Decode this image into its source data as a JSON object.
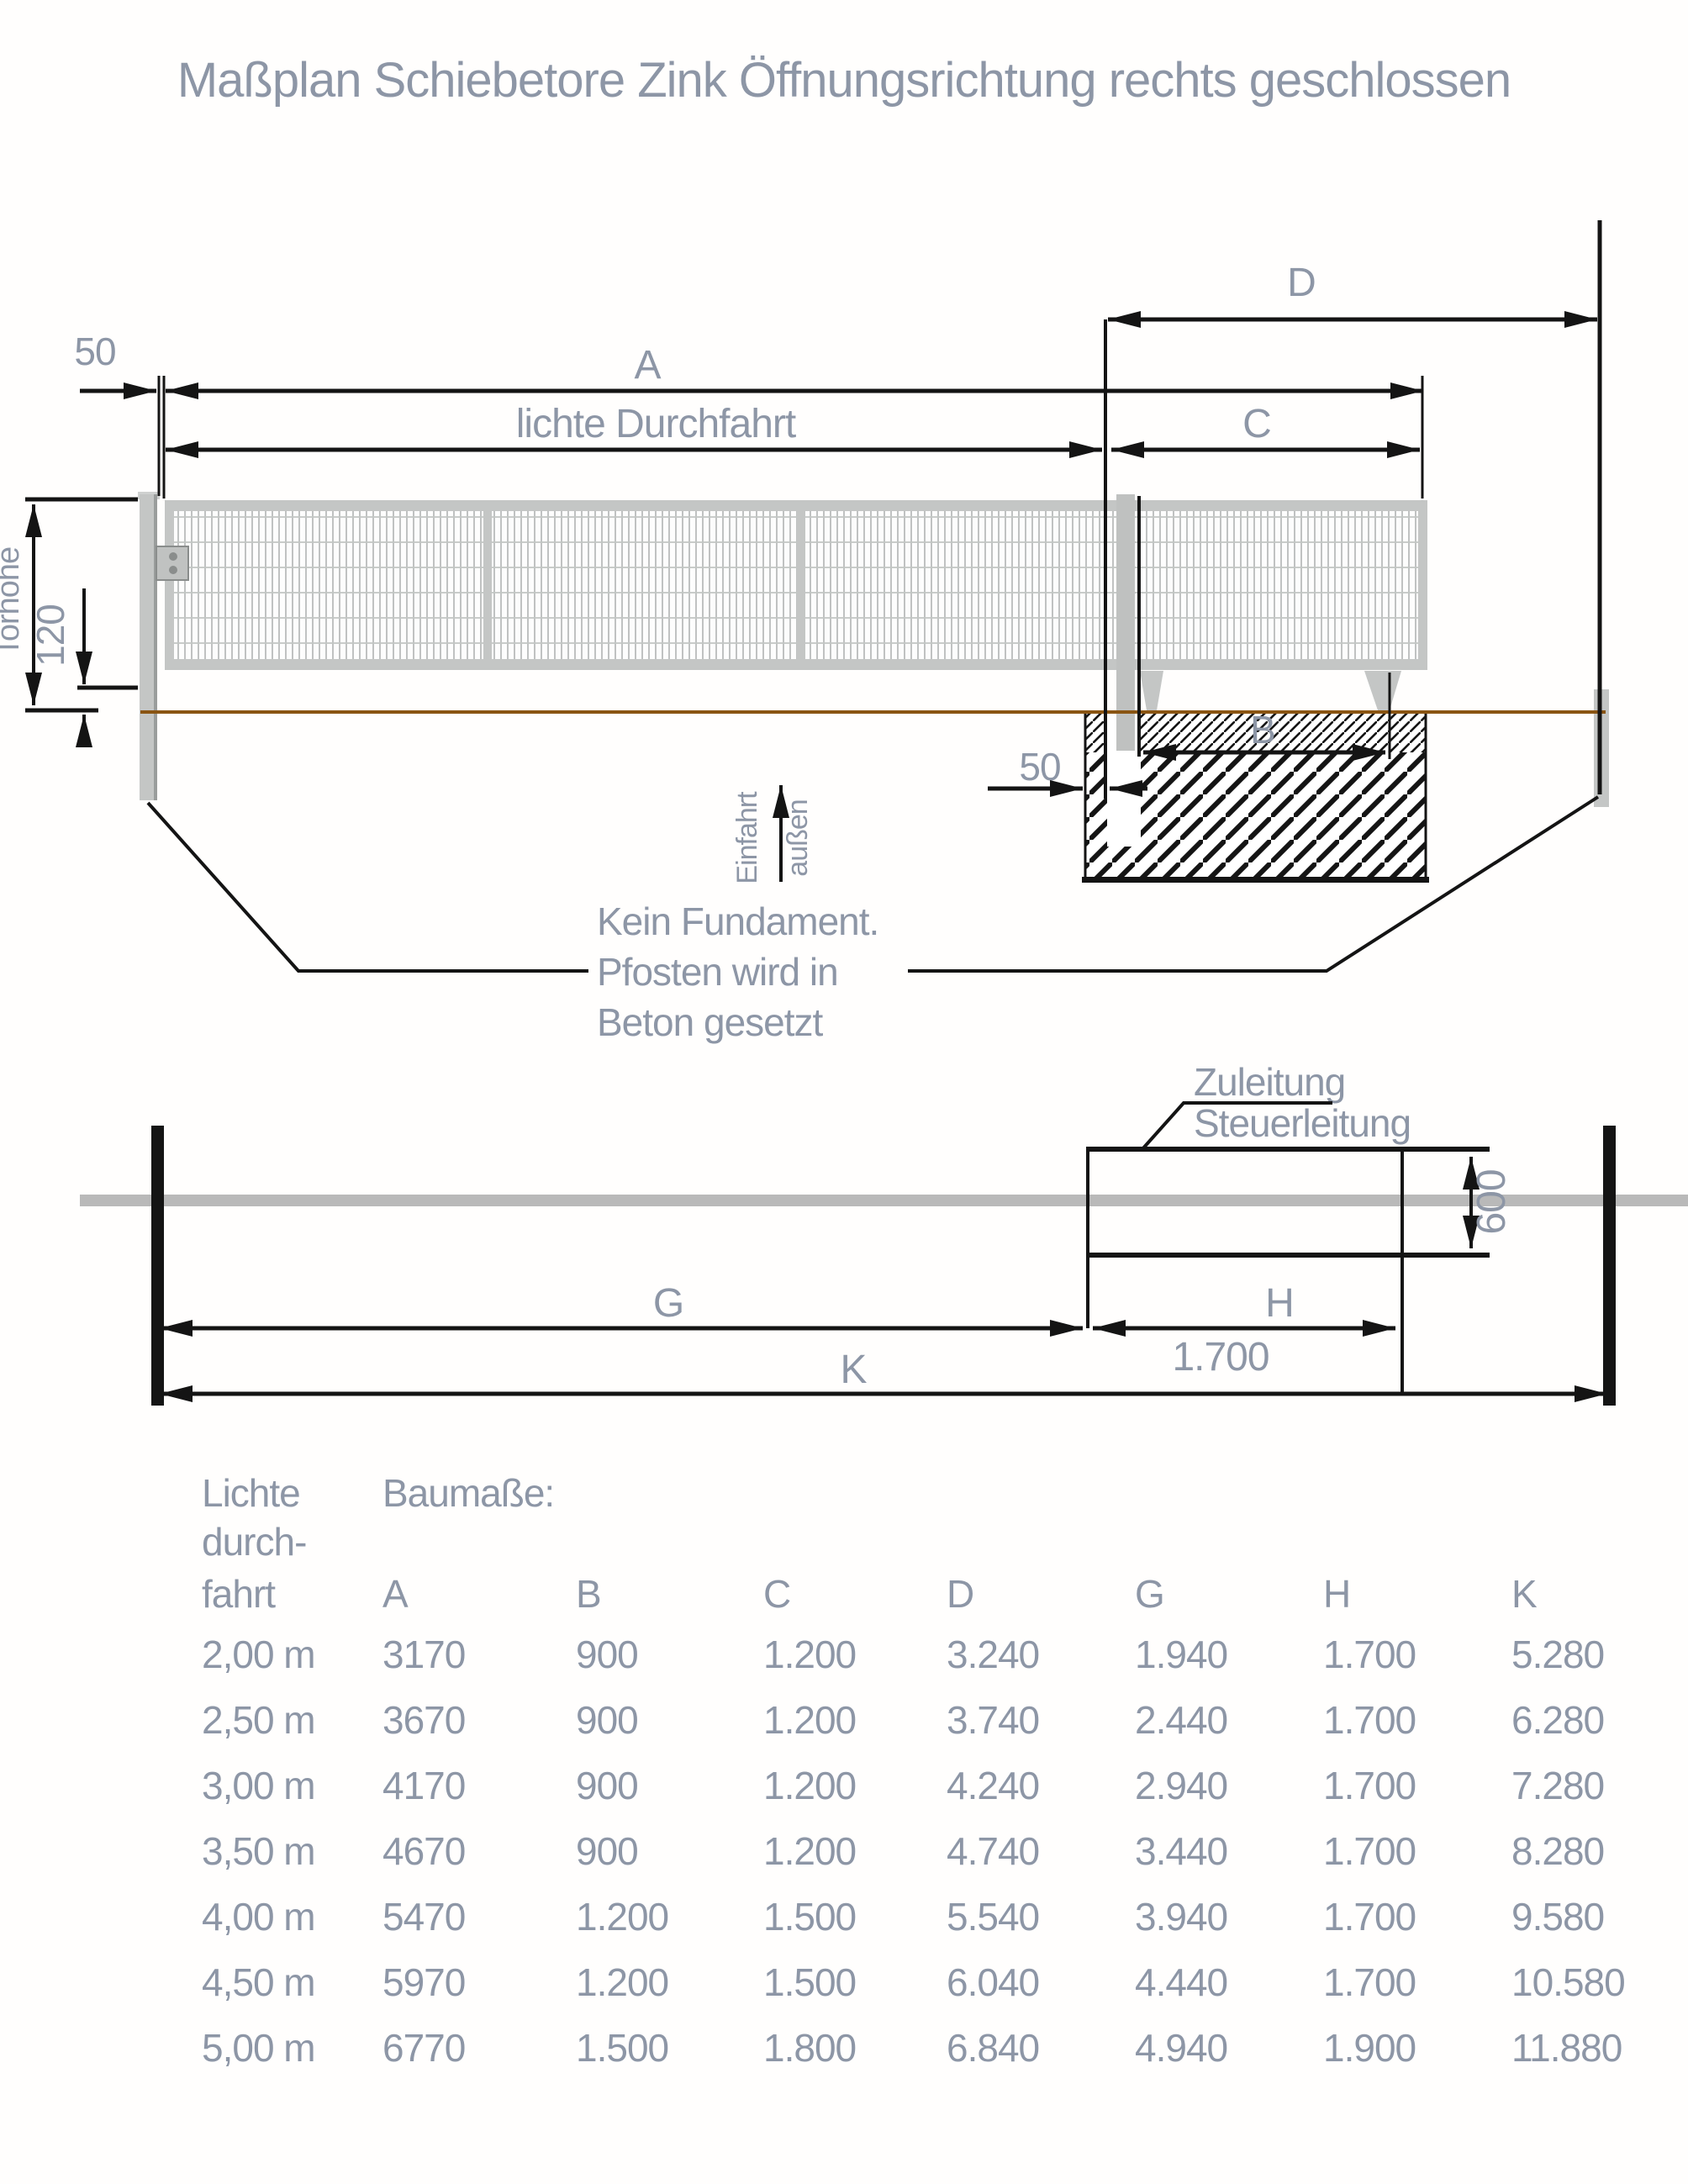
{
  "title": "Maßplan Schiebetore Zink Öffnungsrichtung rechts geschlossen",
  "drawing_elevation": {
    "dim_d": "D",
    "dim_a": "A",
    "dim_clear_passage": "lichte Durchfahrt",
    "dim_c": "C",
    "dim_b": "B",
    "dim_offset_top": "50",
    "dim_offset_bottom": "50",
    "dim_ground_clearance": "120",
    "dim_gate_height": "Torhöhe",
    "direction_label_1": "Einfahrt",
    "direction_label_2": "außen",
    "note_line_1": "Kein Fundament.",
    "note_line_2": "Pfosten wird in",
    "note_line_3": "Beton gesetzt"
  },
  "drawing_plan": {
    "cable_label_1": "Zuleitung",
    "cable_label_2": "Steuerleitung",
    "dim_width": "600",
    "dim_g": "G",
    "dim_h": "H",
    "dim_h_value": "1.700",
    "dim_k": "K"
  },
  "table": {
    "row_header_lines": [
      "Lichte",
      "durch-",
      "fahrt"
    ],
    "group_label": "Baumaße:",
    "columns": [
      "A",
      "B",
      "C",
      "D",
      "G",
      "H",
      "K"
    ],
    "rows": [
      {
        "ld": "2,00 m",
        "A": "3170",
        "B": "900",
        "C": "1.200",
        "D": "3.240",
        "G": "1.940",
        "H": "1.700",
        "K": "5.280"
      },
      {
        "ld": "2,50 m",
        "A": "3670",
        "B": "900",
        "C": "1.200",
        "D": "3.740",
        "G": "2.440",
        "H": "1.700",
        "K": "6.280"
      },
      {
        "ld": "3,00 m",
        "A": "4170",
        "B": "900",
        "C": "1.200",
        "D": "4.240",
        "G": "2.940",
        "H": "1.700",
        "K": "7.280"
      },
      {
        "ld": "3,50 m",
        "A": "4670",
        "B": "900",
        "C": "1.200",
        "D": "4.740",
        "G": "3.440",
        "H": "1.700",
        "K": "8.280"
      },
      {
        "ld": "4,00 m",
        "A": "5470",
        "B": "1.200",
        "C": "1.500",
        "D": "5.540",
        "G": "3.940",
        "H": "1.700",
        "K": "9.580"
      },
      {
        "ld": "4,50 m",
        "A": "5970",
        "B": "1.200",
        "C": "1.500",
        "D": "6.040",
        "G": "4.440",
        "H": "1.700",
        "K": "10.580"
      },
      {
        "ld": "5,00 m",
        "A": "6770",
        "B": "1.500",
        "C": "1.800",
        "D": "6.840",
        "G": "4.940",
        "H": "1.900",
        "K": "11.880"
      }
    ]
  },
  "colors": {
    "label_gray": "#8d96a6",
    "line_black": "#141414",
    "steel_light": "#c4c6c5",
    "ground_brown": "#8a5513",
    "fence_band": "#b9b9b9"
  }
}
